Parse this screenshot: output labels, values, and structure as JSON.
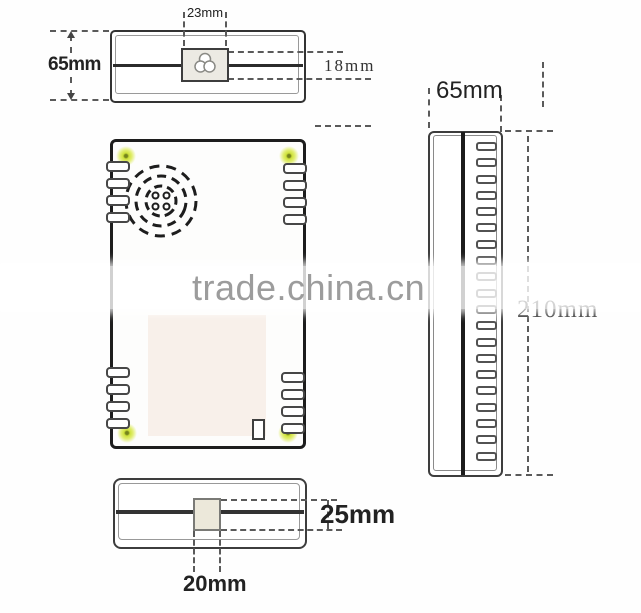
{
  "watermark": {
    "text": "trade.china.cn"
  },
  "dimensions": {
    "top_view": {
      "connector_width": "23mm",
      "body_depth": "65mm",
      "connector_height": "18mm"
    },
    "side_view": {
      "depth": "65mm",
      "height": "210mm"
    },
    "bottom_view": {
      "block_height": "25mm",
      "block_width": "20mm"
    }
  },
  "colors": {
    "outline": "#222222",
    "screw_glow": "#dce94f",
    "screw_center": "#75841c",
    "connector_fill": "#eceae3",
    "label_panel_fill": "#f8f0ea",
    "bottom_block_fill": "#ece8da",
    "watermark_text": "#9c9c9c"
  }
}
